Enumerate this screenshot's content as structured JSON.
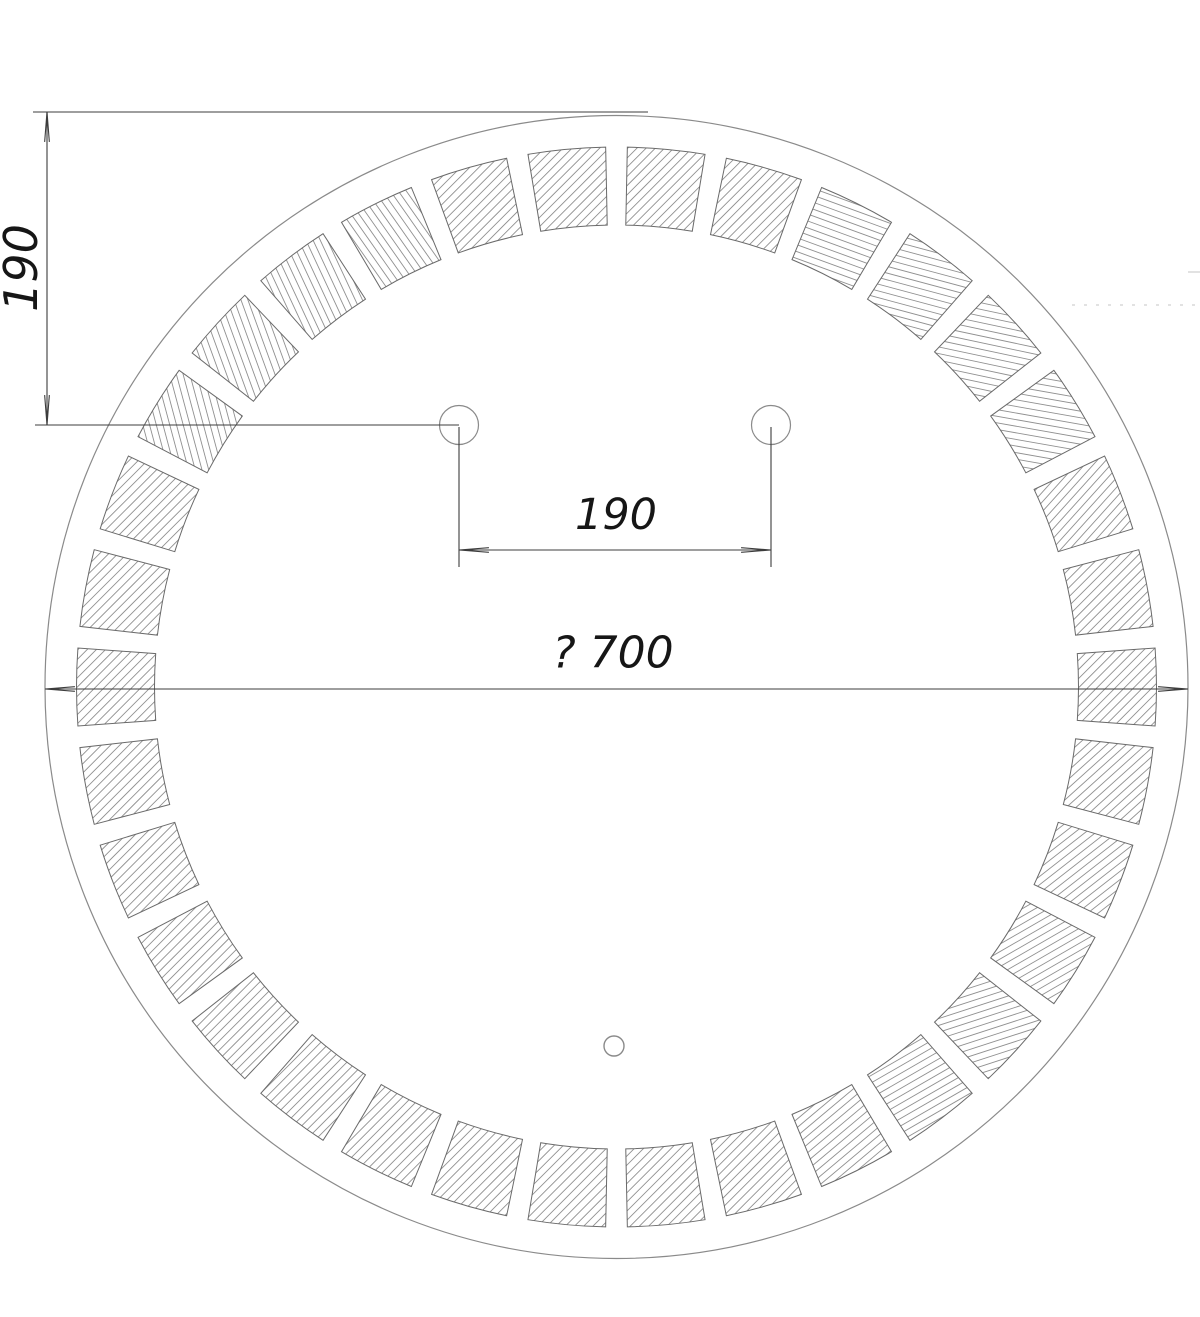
{
  "drawing_type": "technical-drawing-round-mirror-front-view",
  "dimensions": {
    "left_vertical": {
      "label": "190"
    },
    "hole_spacing": {
      "label": "190"
    },
    "diameter": {
      "label": "? 700"
    }
  },
  "labels": {
    "left_vertical_pos": {
      "x": 21,
      "y": 268,
      "size": 46
    },
    "hole_spacing_pos": {
      "x": 616,
      "y": 515,
      "size": 43
    },
    "diameter_pos": {
      "x": 613,
      "y": 653,
      "size": 44
    }
  },
  "colors": {
    "background": "#ffffff",
    "outline": "#8a8a8a",
    "segment_outline": "#6a6a6a",
    "hatch": "#909090",
    "dimension": "#3c3c3c",
    "text": "#161616",
    "faint": "#c4c4c4"
  },
  "geometry": {
    "canvas": {
      "w": 1200,
      "h": 1317
    },
    "circle": {
      "cx": 616.5,
      "cy": 687,
      "r": 571.5
    },
    "segment_ring": {
      "outer_r": 540,
      "inner_r": 462,
      "count": 34,
      "gap_deg": 2.3,
      "hatch_spacing": 6.5,
      "hatch_angles": [
        45,
        45,
        160,
        165,
        168,
        170,
        48,
        45,
        45,
        42,
        38,
        30,
        18,
        30,
        40,
        45,
        45,
        45,
        45,
        45,
        45,
        45,
        45,
        45,
        45,
        45,
        45,
        45,
        105,
        110,
        115,
        125,
        45,
        45
      ]
    },
    "holes": {
      "left": {
        "cx": 459,
        "cy": 425,
        "r": 19.5
      },
      "right": {
        "cx": 771,
        "cy": 425,
        "r": 19.5
      },
      "sensor": {
        "cx": 614,
        "cy": 1046,
        "r": 10
      }
    },
    "dim_left_vertical": {
      "top_ext_line": {
        "x1": 33,
        "y1": 112,
        "x2": 648,
        "y2": 112
      },
      "hole_ext_line": {
        "x1": 35,
        "y1": 425,
        "x2": 459,
        "y2": 425
      },
      "dim_line": {
        "x": 47,
        "y1": 112,
        "y2": 425
      }
    },
    "dim_hole_spacing": {
      "drop_left": {
        "x": 459,
        "y1": 427,
        "y2": 567
      },
      "drop_right": {
        "x": 771,
        "y1": 427,
        "y2": 567
      },
      "dim_line": {
        "y": 550,
        "x1": 459,
        "x2": 771
      }
    },
    "dim_diameter": {
      "dim_line": {
        "y": 689,
        "x1": 45,
        "x2": 1188
      }
    },
    "faint_marks": {
      "dotted_line": {
        "x1": 1072,
        "y1": 305,
        "x2": 1200,
        "y2": 305
      },
      "sliver": {
        "x1": 1188,
        "y1": 272,
        "x2": 1200,
        "y2": 272
      }
    },
    "arrow": {
      "length": 30,
      "spread_deg": 4.5
    }
  }
}
